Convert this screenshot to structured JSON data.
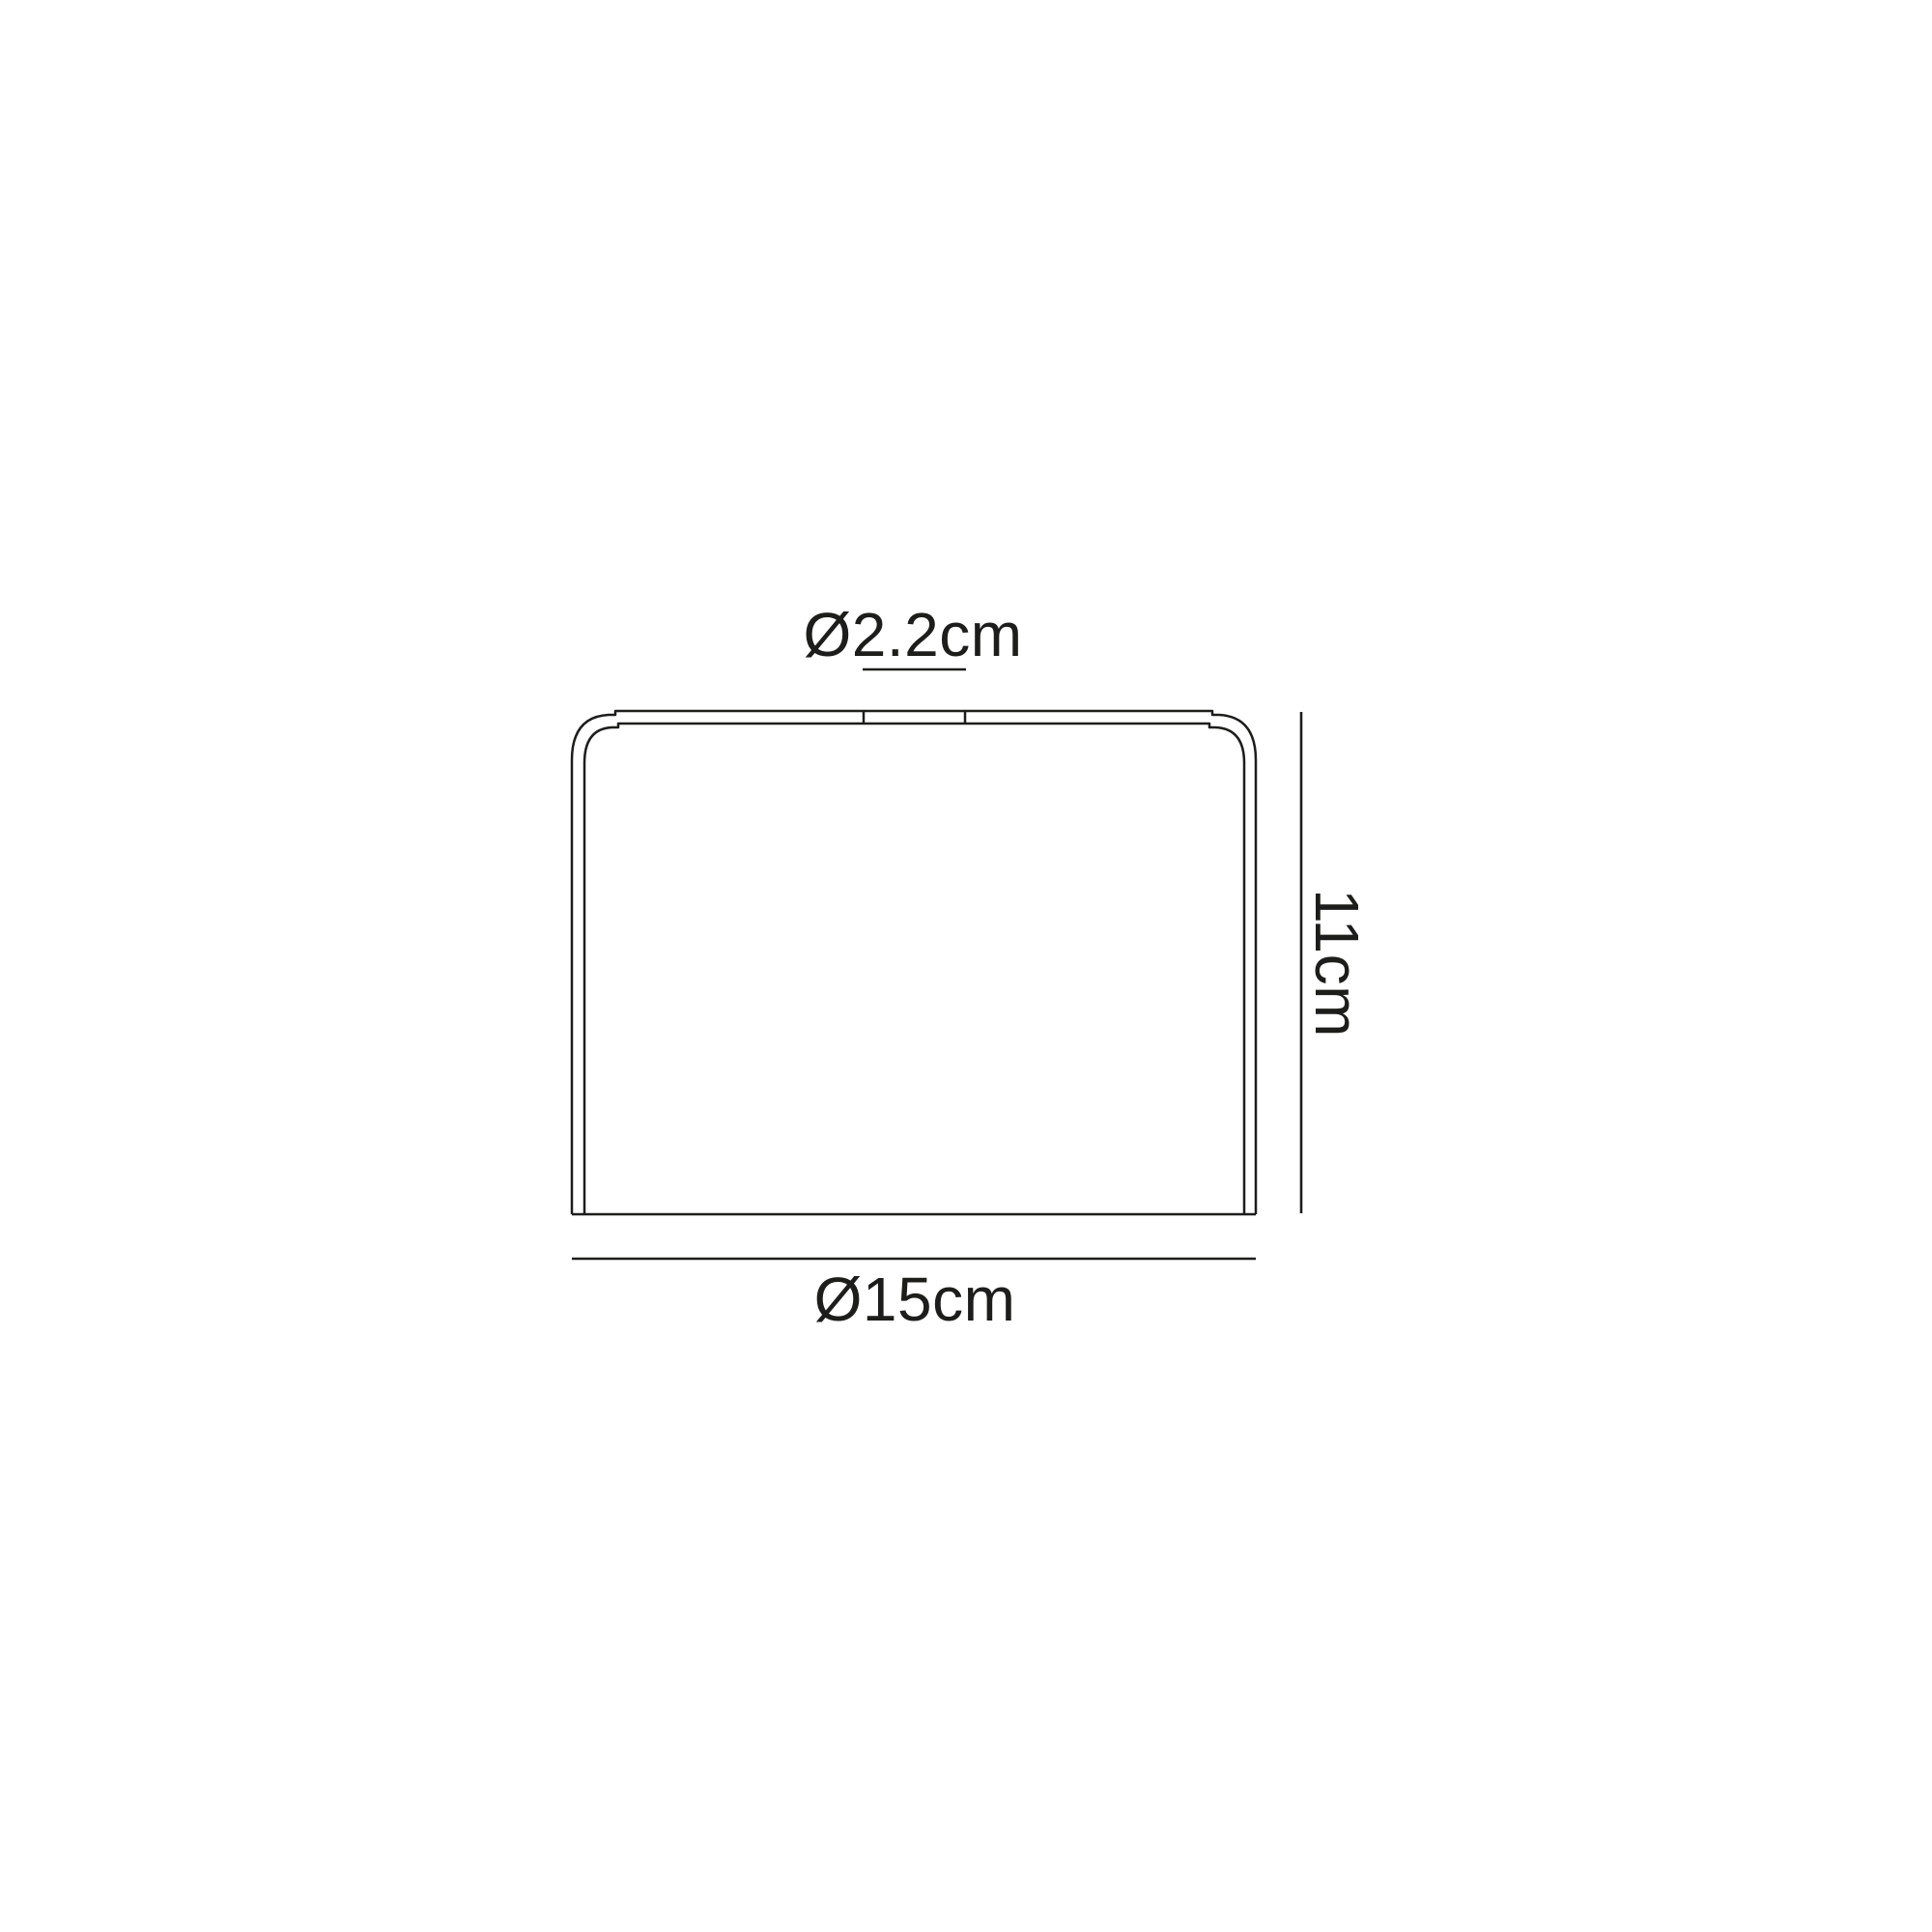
{
  "diagram": {
    "labels": {
      "top_diameter": "Ø2.2cm",
      "height": "11cm",
      "bottom_diameter": "Ø15cm"
    },
    "colors": {
      "line": "#1d1d1b",
      "background": "#ffffff"
    }
  }
}
